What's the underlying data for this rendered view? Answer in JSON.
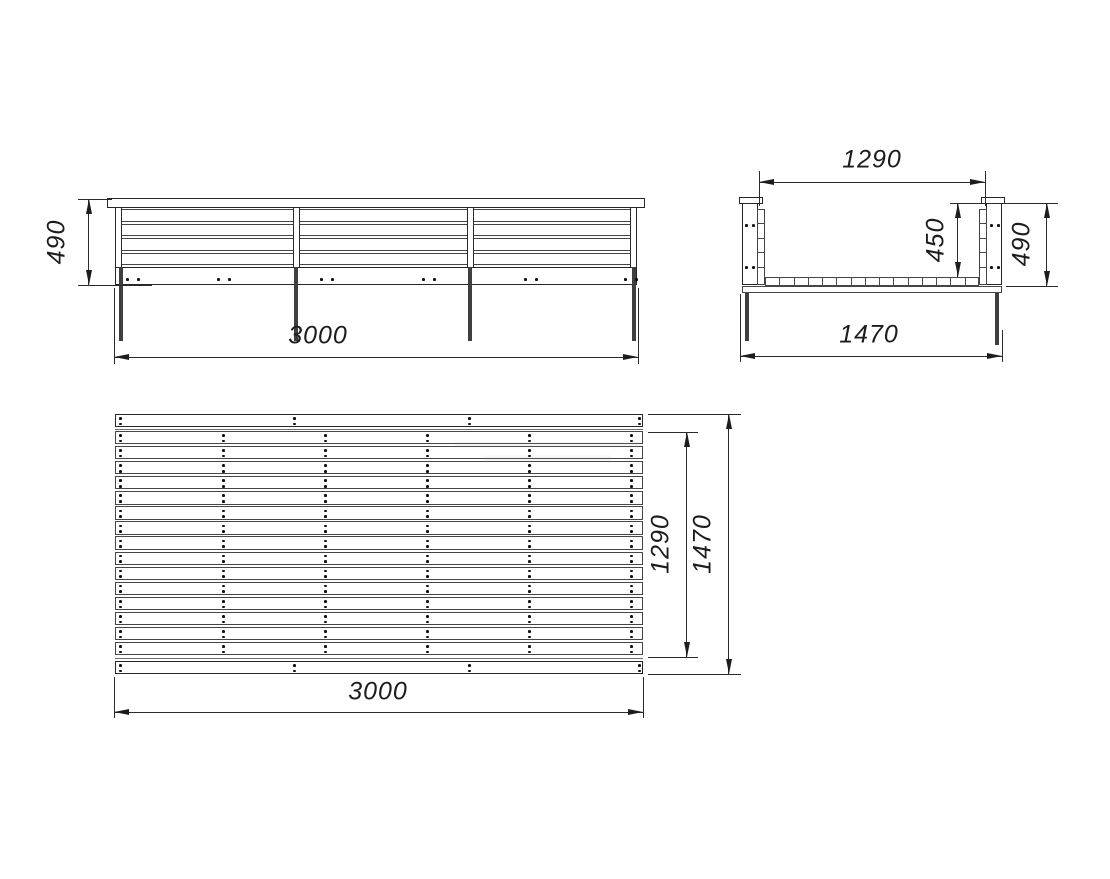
{
  "drawing": {
    "background": "#ffffff",
    "line_color": "#262626",
    "views": {
      "front": {
        "name": "front-elevation",
        "height_label": "490",
        "length_label": "3000",
        "wall_slat_count": 4,
        "post_count": 4,
        "leg_count": 4,
        "screw_column_count": 6
      },
      "side": {
        "name": "end-view",
        "top_width_label": "1290",
        "inner_height_label": "450",
        "outer_height_label": "490",
        "overall_width_label": "1470",
        "floor_slat_count": 15
      },
      "plan": {
        "name": "top-view",
        "inner_width_label": "1290",
        "overall_width_label": "1470",
        "length_label": "3000",
        "floor_slat_count": 15,
        "screw_column_count": 6,
        "rail_screw_column_count": 4
      }
    }
  }
}
